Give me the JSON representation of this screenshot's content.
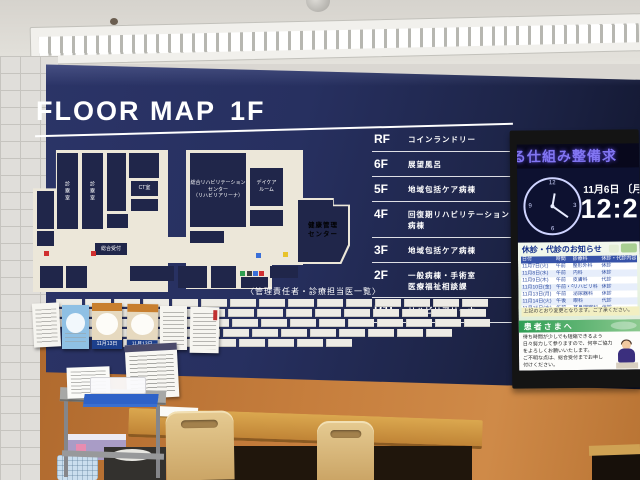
{
  "sign": {
    "title": "FLOOR MAP",
    "floor": "1F",
    "legend": [
      {
        "floor": "RF",
        "name": "コインランドリー"
      },
      {
        "floor": "6F",
        "name": "展望風呂"
      },
      {
        "floor": "5F",
        "name": "地域包括ケア病棟"
      },
      {
        "floor": "4F",
        "name": "回復期リハビリテーション病棟"
      },
      {
        "floor": "3F",
        "name": "地域包括ケア病棟"
      },
      {
        "floor": "2F",
        "name": "一般病棟・手術室",
        "name2": "医療福祉相談課"
      },
      {
        "floor": "B1F",
        "name": "リハビリアリーナ"
      }
    ],
    "map": {
      "rehab_center": "総合リハビリテーション\nセンター\n（リハビリアリーナ）",
      "daycare": "デイケア\nルーム",
      "health_center": "健康管理\nセンター",
      "ct_room": "CT室",
      "exam_room_a": "診察室",
      "exam_room_b": "診察室",
      "reception": "総合受付"
    },
    "staff_board": {
      "heading": "〈管理責任者・診療担当医一覧〉",
      "plate_rows": [
        15,
        15,
        15,
        13,
        9
      ]
    }
  },
  "display": {
    "ticker": "る仕組み整備求",
    "date": "11月6日",
    "weekday": "〔月〕",
    "time": "12:21",
    "notice": {
      "title": "休診・代診のお知らせ",
      "headers": [
        "日付",
        "時間",
        "診療科",
        "休診・代診内容"
      ],
      "rows": [
        [
          "11月7日(火)",
          "午前",
          "整形外科",
          "休診"
        ],
        [
          "11月8日(水)",
          "午前",
          "内科",
          "休診"
        ],
        [
          "11月9日(木)",
          "午前",
          "皮膚科",
          "代診"
        ],
        [
          "11月10日(金)",
          "午前・午後",
          "リハビリ科",
          "休診"
        ],
        [
          "11月13日(月)",
          "午前",
          "泌尿器科",
          "休診"
        ],
        [
          "11月14日(火)",
          "午後",
          "眼科",
          "代診"
        ],
        [
          "11月15日(水)",
          "午前",
          "耳鼻咽喉科",
          "休診"
        ]
      ],
      "footer": "上記のとおり変更となります。ご了承ください。"
    },
    "patient": {
      "title": "患者さまへ",
      "lines": "待ち時間が少しでも短縮できるよう\n日々努力して参りますので、何卒ご協力\nをよろしくお願いいたします。\nご不明な点は、総合受付までお申し\n付けください。"
    }
  },
  "wall": {
    "posters": [
      {
        "type": "text"
      },
      {
        "type": "blue"
      },
      {
        "type": "orange",
        "date": "11月13日"
      },
      {
        "type": "orange",
        "date": "11月13日"
      },
      {
        "type": "text"
      },
      {
        "type": "text-red"
      }
    ]
  }
}
